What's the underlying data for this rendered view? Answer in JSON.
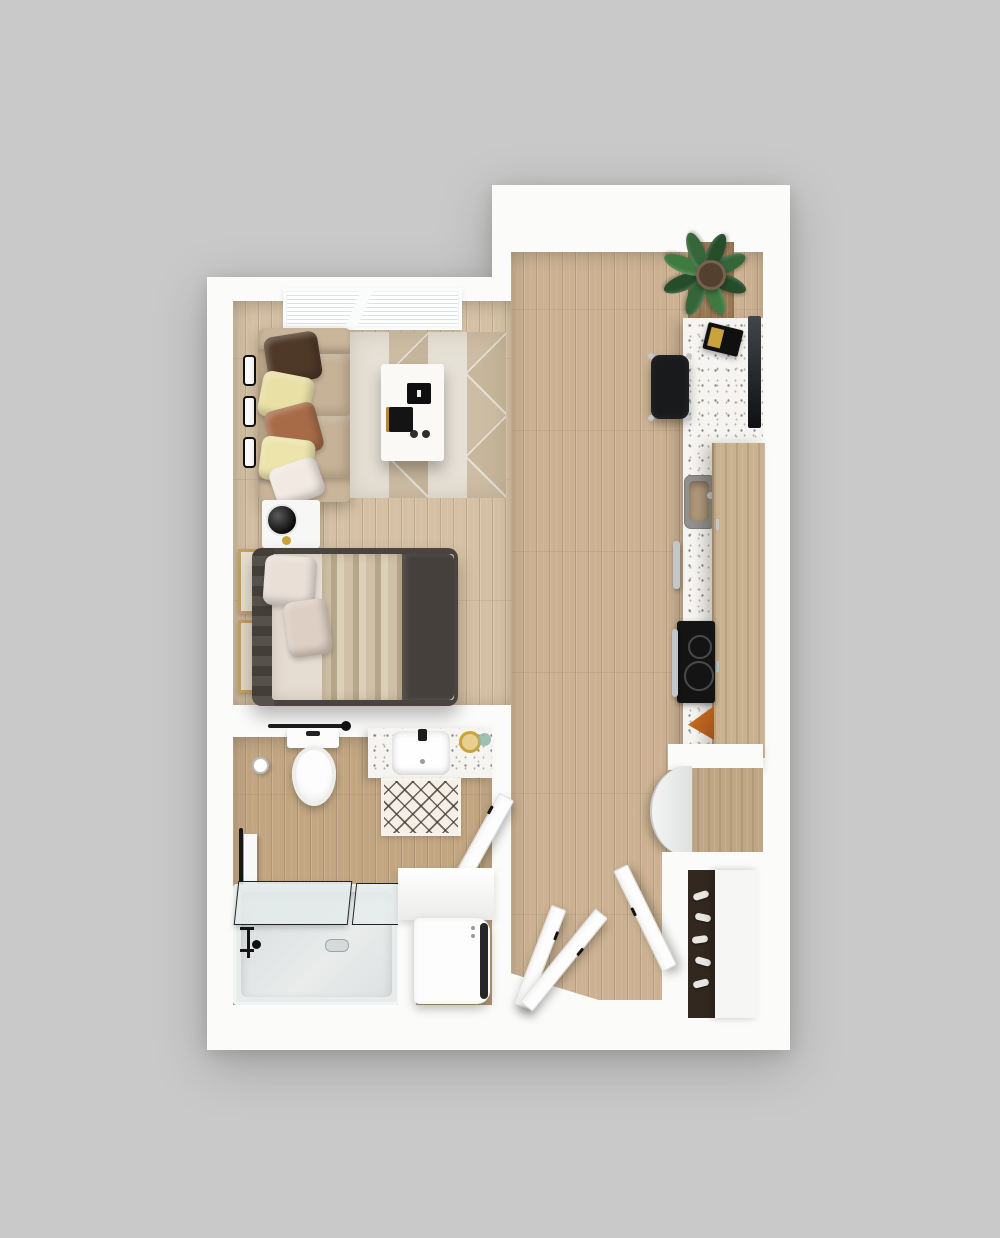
{
  "scene": {
    "kind": "3d-floor-plan-render",
    "layout": "studio-apartment",
    "view": "top-down",
    "background": "#c9c9c9",
    "visible_text": ""
  },
  "palette": {
    "bg": "#c9c9c9",
    "wall": "#fbfbfa",
    "wall-shade": "#e6e6e4",
    "wood-light": "#d5c0a3",
    "wood-mid": "#ccb292",
    "wood-dark": "#c2a682",
    "rug-light": "#e6e1d6",
    "rug-dark": "#c6b69c",
    "sofa": "#c2ae92",
    "pillow-brown": "#4e3827",
    "pillow-yellow": "#e9e0a6",
    "pillow-rust": "#a76b48",
    "pillow-cream": "#f2eae2",
    "bed-frame": "#4a4440",
    "duvet": "#45403b",
    "sheet": "#e5dcd2",
    "terrazzo": "#f5f4f0",
    "cabinet-wood": "#c8b290",
    "black": "#161616",
    "plant-green": "#35663a",
    "plant-dark": "#264d2a",
    "gold": "#c9a33c",
    "tub": "#dfe4e4",
    "steel": "#c3c7c9"
  },
  "rooms": [
    {
      "id": "living-sleeping-area",
      "floor": "light-wood-plank",
      "items": [
        "window-blinds",
        "wall-vent-bars-x3",
        "sofa",
        "throw-pillows-x5",
        "geometric-area-rug",
        "coffee-table",
        "serving-trays-x2",
        "nightstand",
        "table-lamp",
        "platform-bed",
        "bed-pillows-x2",
        "striped-throw-blanket",
        "dark-duvet",
        "wall-art-frames-x2"
      ]
    },
    {
      "id": "bathroom",
      "floor": "wood-plank",
      "items": [
        "toilet",
        "towel-bar",
        "robe-hook",
        "toilet-paper-holder",
        "terrazzo-vanity",
        "basin-sink",
        "black-faucet",
        "gold-soap-dish",
        "glass-jar",
        "diamond-bath-mat",
        "swing-door",
        "towel-rail-with-towel",
        "bathtub",
        "glass-tub-screens-x2",
        "tub-faucet",
        "drain",
        "washer-dryer",
        "laundry-niche"
      ]
    },
    {
      "id": "kitchen-hallway",
      "floor": "wood-plank",
      "items": [
        "potted-plant",
        "wood-accent-panel",
        "terrazzo-counter",
        "desk-chair",
        "laptop",
        "wall-mounted-tv",
        "kitchen-sink",
        "dishwasher-handle",
        "oven-handle",
        "induction-cooktop-2-burners",
        "cutting-board",
        "refrigerator",
        "tall-wood-cabinet",
        "upper-cabinets",
        "entry-closet",
        "shoe-shelf",
        "sliding-closet-panel",
        "open-doors-x3"
      ]
    }
  ]
}
